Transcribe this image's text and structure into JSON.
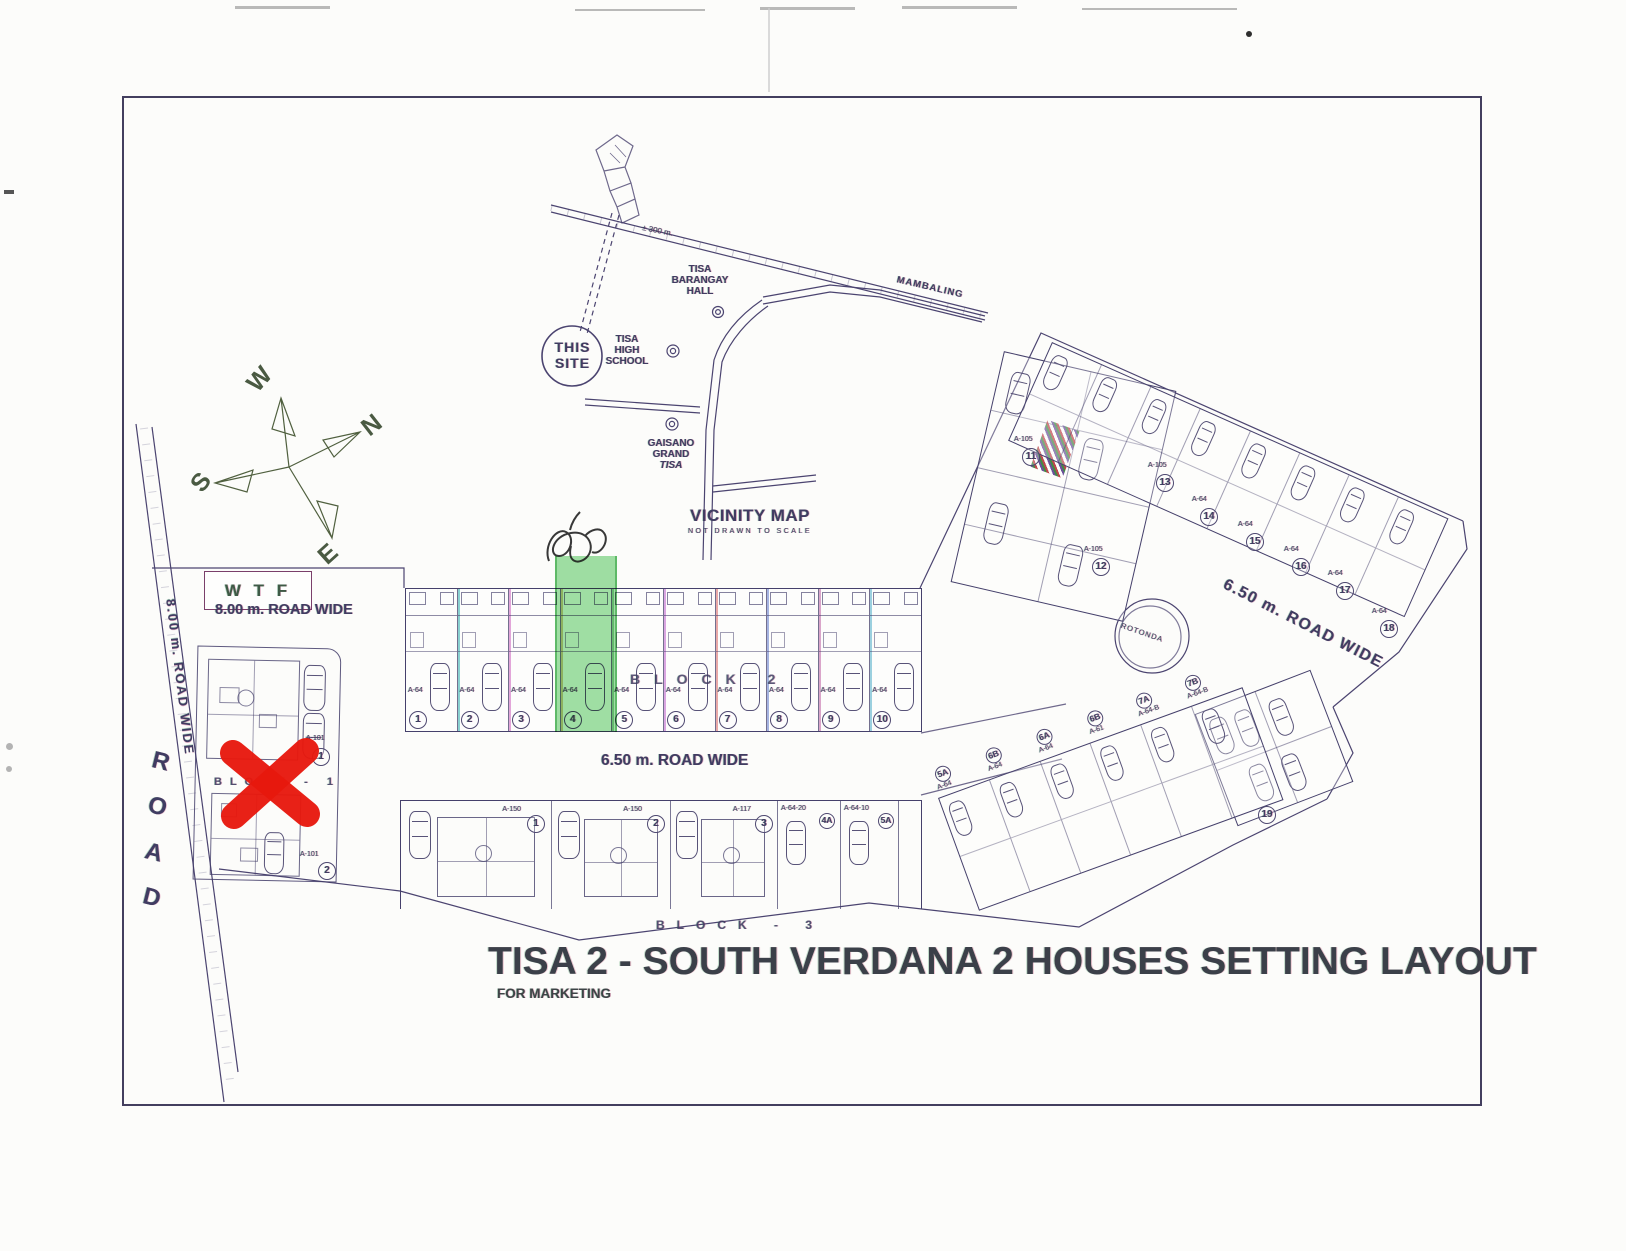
{
  "document": {
    "title": "TISA 2 - SOUTH VERDANA 2 HOUSES SETTING LAYOUT",
    "subtitle": "FOR MARKETING"
  },
  "vicinity": {
    "title": "VICINITY MAP",
    "scale_note": "NOT DRAWN TO SCALE",
    "this_site": [
      "THIS",
      "SITE"
    ],
    "barangay_hall": [
      "TISA",
      "BARANGAY",
      "HALL"
    ],
    "high_school": [
      "TISA",
      "HIGH",
      "SCHOOL"
    ],
    "gaisano": [
      "GAISANO",
      "GRAND",
      "TISA"
    ],
    "distance": "± 300 m.",
    "road_name": "MAMBALING"
  },
  "compass": {
    "w": "W",
    "n": "N",
    "s": "S",
    "e": "E"
  },
  "annotations": {
    "wtf": "W T F"
  },
  "roads": {
    "top_left": "8.00 m. ROAD WIDE",
    "left_diagonal": "8.00 m. ROAD WIDE",
    "left_name": [
      "R",
      "O",
      "A",
      "D"
    ],
    "center": "6.50 m. ROAD WIDE",
    "right": "6.50 m. ROAD WIDE",
    "rotonda": "ROTONDA"
  },
  "block1": {
    "label": "BLOCK - 1",
    "units": [
      {
        "model": "A-101",
        "number": "1"
      },
      {
        "model": "A-101",
        "number": "2"
      }
    ]
  },
  "block2": {
    "label": "BLOCK  2",
    "units": [
      {
        "model": "A-64",
        "number": "1"
      },
      {
        "model": "A-64",
        "number": "2"
      },
      {
        "model": "A-64",
        "number": "3"
      },
      {
        "model": "A-64",
        "number": "4"
      },
      {
        "model": "A-64",
        "number": "5"
      },
      {
        "model": "A-64",
        "number": "6"
      },
      {
        "model": "A-64",
        "number": "7"
      },
      {
        "model": "A-64",
        "number": "8"
      },
      {
        "model": "A-64",
        "number": "9"
      },
      {
        "model": "A-64",
        "number": "10"
      }
    ]
  },
  "block3": {
    "label": "BLOCK - 3",
    "units": [
      {
        "model": "A-150",
        "number": "1"
      },
      {
        "model": "A-150",
        "number": "2"
      },
      {
        "model": "A-117",
        "number": "3"
      },
      {
        "model": "A-64-20",
        "number": "4A"
      },
      {
        "model": "A-64-10",
        "number": "5A"
      }
    ]
  },
  "right_upper": {
    "units": [
      {
        "model": "A-105",
        "number": "11"
      },
      {
        "model": "A-105",
        "number": "12"
      },
      {
        "model": "A-105",
        "number": "13"
      },
      {
        "model": "A-64",
        "number": "14"
      },
      {
        "model": "A-64",
        "number": "15"
      },
      {
        "model": "A-64",
        "number": "16"
      },
      {
        "model": "A-64",
        "number": "17"
      },
      {
        "model": "A-64",
        "number": "18"
      }
    ]
  },
  "right_lower": {
    "units": [
      {
        "model": "A-64",
        "number": "5A"
      },
      {
        "model": "A-64",
        "number": "6B"
      },
      {
        "model": "A-64",
        "number": "6A"
      },
      {
        "model": "A-61",
        "number": "6B"
      },
      {
        "model": "A-64-B",
        "number": "7A"
      },
      {
        "model": "A-64-B",
        "number": "7B"
      }
    ],
    "lot19": {
      "number": "19"
    }
  },
  "highlight_color": "#49c452",
  "redx_color": "#e7180e"
}
